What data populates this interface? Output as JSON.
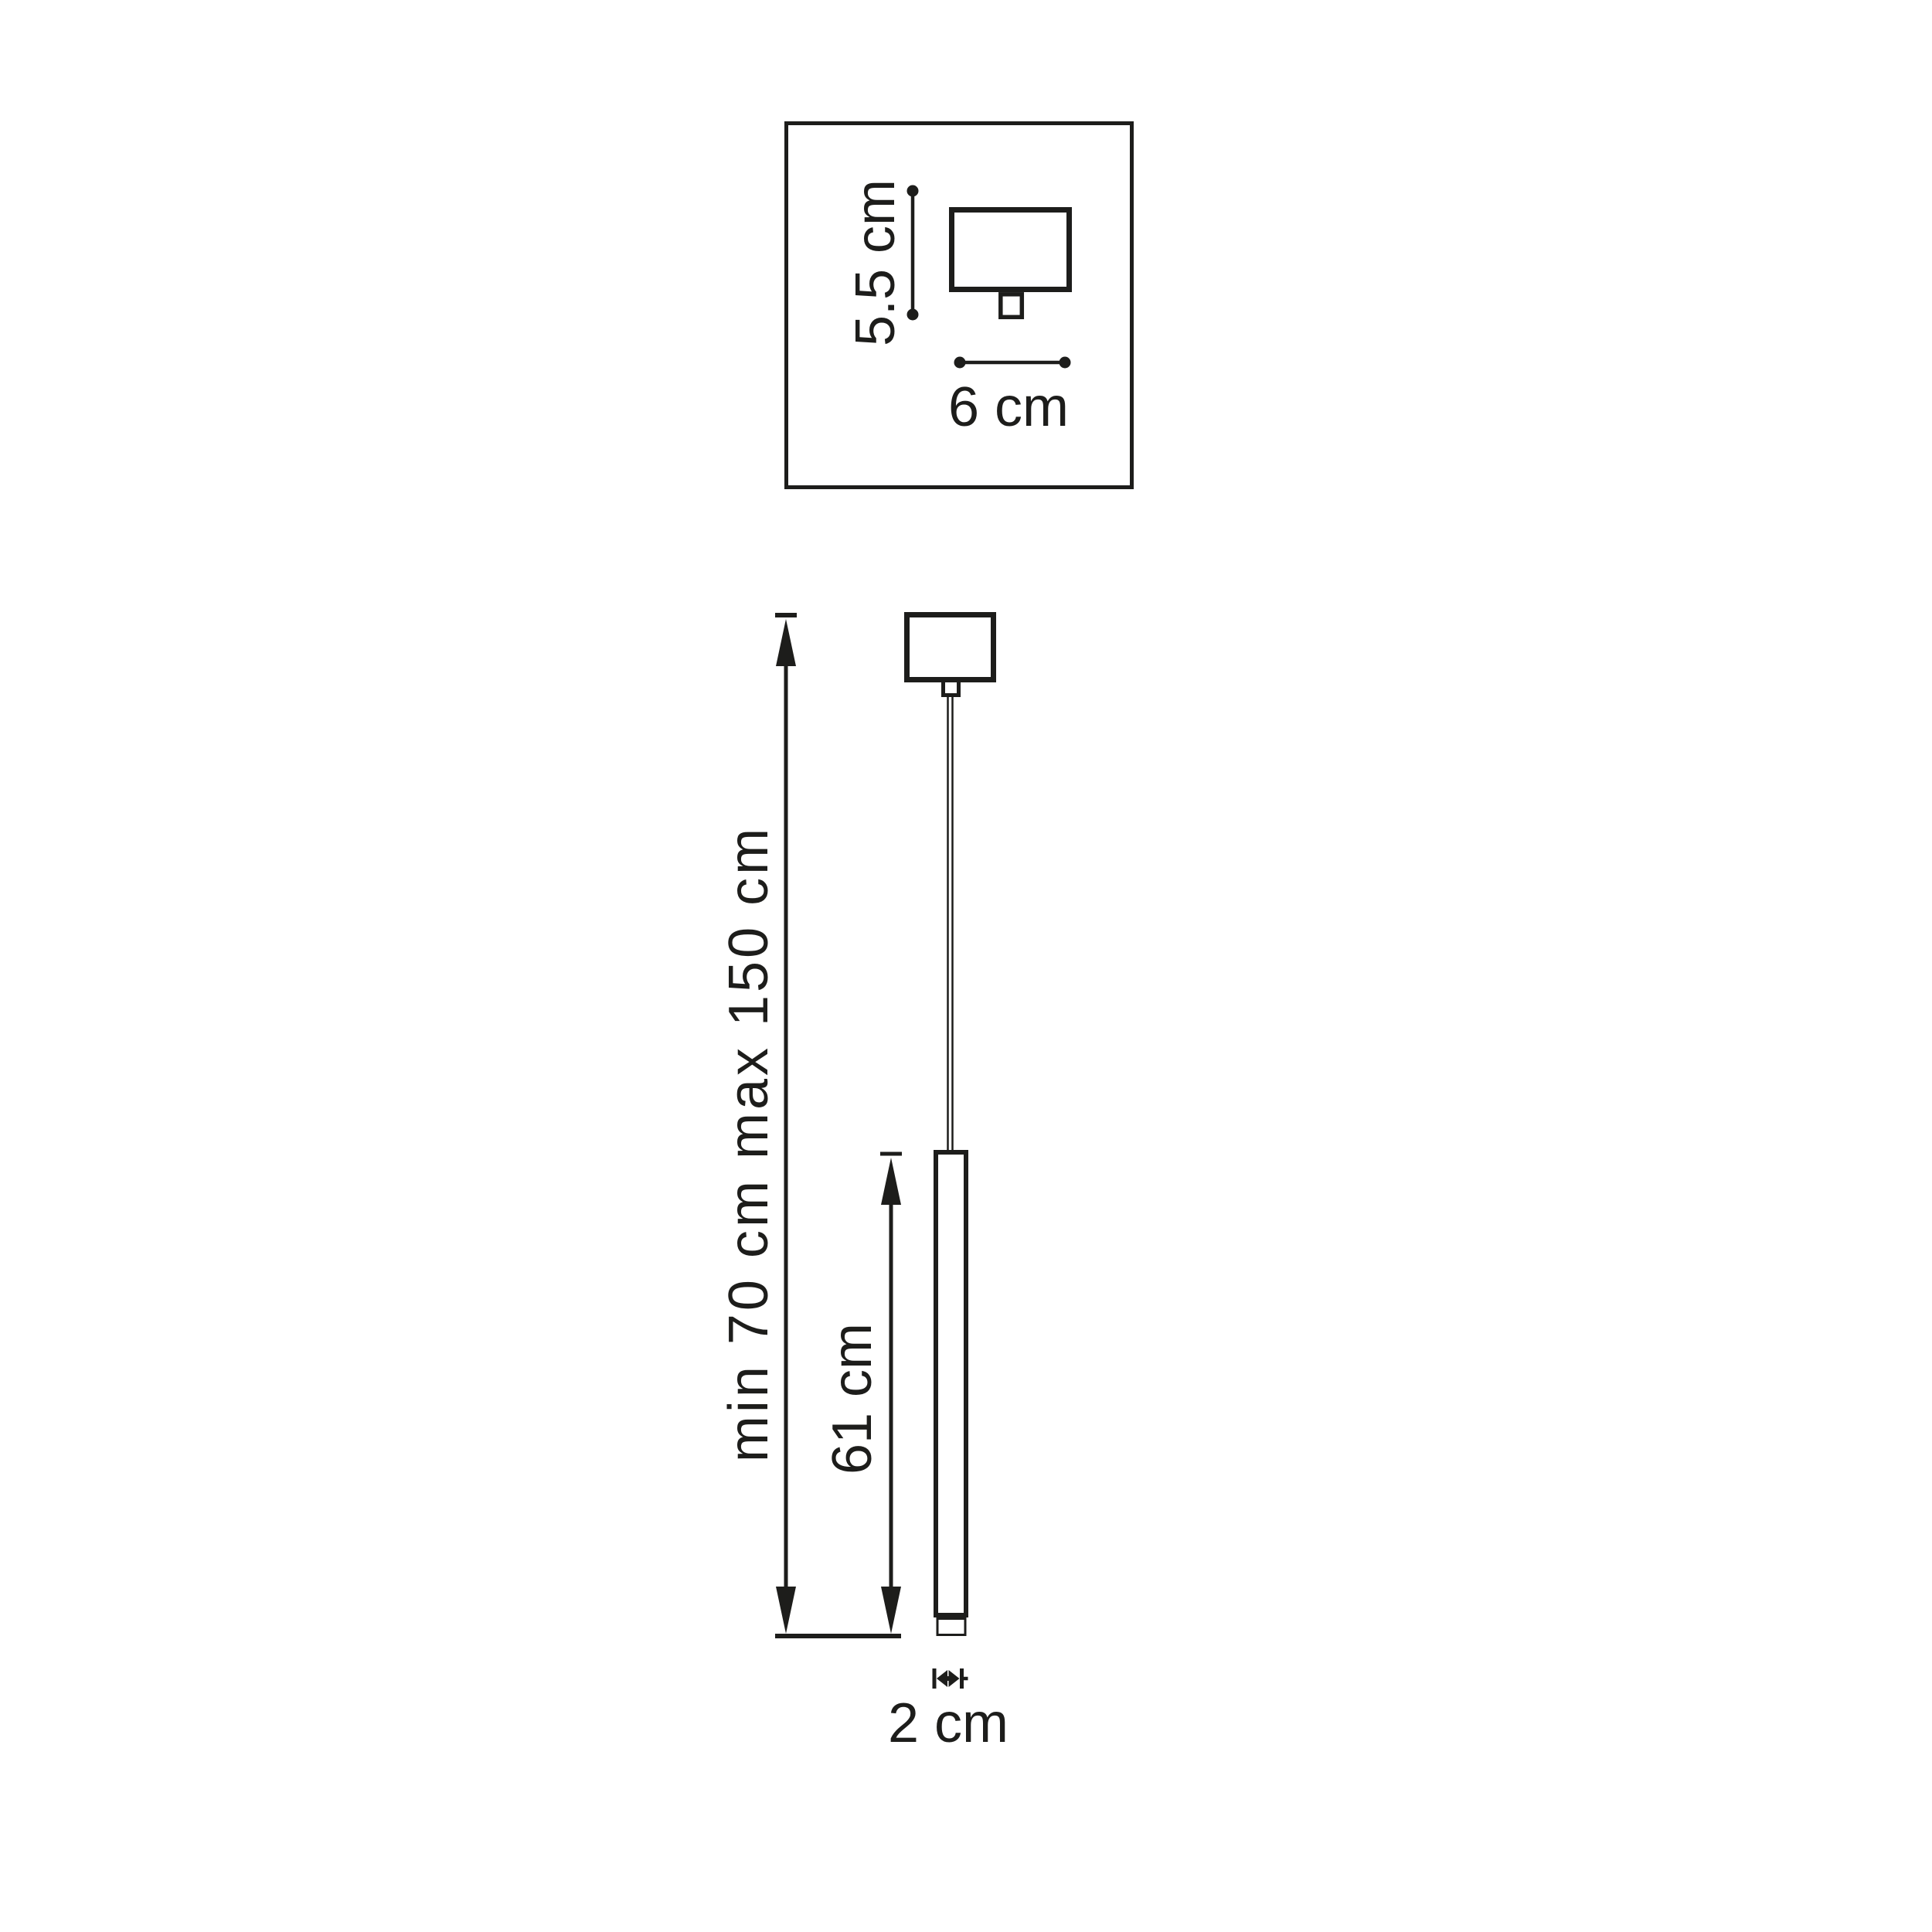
{
  "colors": {
    "ink": "#1d1d1b",
    "background": "#ffffff"
  },
  "detail_inset": {
    "height_label": "5.5 cm",
    "width_label": "6 cm"
  },
  "main_view": {
    "suspension_height_label": "min 70 cm max 150 cm",
    "tube_length_label": "61 cm",
    "tube_diameter_label": "2 cm"
  }
}
